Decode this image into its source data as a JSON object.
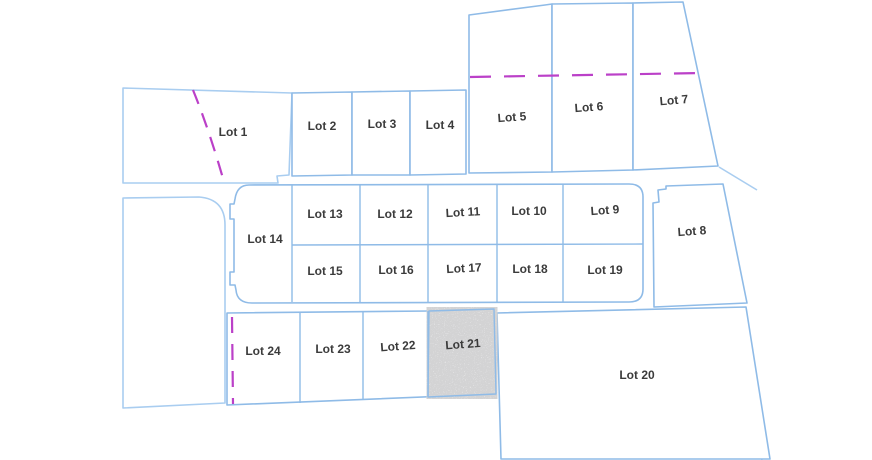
{
  "diagram": {
    "type": "plat-lot-map",
    "colors": {
      "background": "#ffffff",
      "parcel_line": "#8fbbe7",
      "parcel_line_light": "#a9cdf0",
      "easement_line": "#bb40c8",
      "label_text": "#3b3b3b",
      "stipple_fill": "#a6a6a6"
    },
    "lots": [
      {
        "id": "lot-1",
        "label": "Lot 1",
        "outline": "M123,88 L292,93 L289,175 L277,176 L278,183 L123,183 Z",
        "label_x": 233,
        "label_y": 133,
        "label_rotation": 0,
        "tone": "light"
      },
      {
        "id": "lot-2",
        "label": "Lot 2",
        "outline": "M292,93 L352,92 L352,175 L292,176 Z",
        "label_x": 322,
        "label_y": 127,
        "label_rotation": 0,
        "tone": "normal"
      },
      {
        "id": "lot-3",
        "label": "Lot 3",
        "outline": "M352,92 L410,91 L410,175 L352,175 Z",
        "label_x": 382,
        "label_y": 125,
        "label_rotation": 0,
        "tone": "normal"
      },
      {
        "id": "lot-4",
        "label": "Lot 4",
        "outline": "M410,91 L466,90 L466,174 L410,175 Z",
        "label_x": 440,
        "label_y": 126,
        "label_rotation": 0,
        "tone": "normal"
      },
      {
        "id": "lot-5",
        "label": "Lot 5",
        "outline": "M469,15 L545,5 L552,4 L552,172 L469,173 Z",
        "label_x": 512,
        "label_y": 118,
        "label_rotation": -4,
        "tone": "normal"
      },
      {
        "id": "lot-6",
        "label": "Lot 6",
        "outline": "M552,4 L633,3 L633,170 L552,172 Z",
        "label_x": 589,
        "label_y": 108,
        "label_rotation": -4,
        "tone": "normal"
      },
      {
        "id": "lot-7",
        "label": "Lot 7",
        "outline": "M633,3 L683,2 L718,166 L633,170 Z",
        "label_x": 674,
        "label_y": 101,
        "label_rotation": -5,
        "tone": "normal"
      },
      {
        "id": "lot-8",
        "label": "Lot 8",
        "outline": "M666,186 L723,184 L747,303 L654,307 L653,203 L659,202 L658,190 L666,189 Z",
        "label_x": 692,
        "label_y": 232,
        "label_rotation": -4,
        "tone": "normal"
      },
      {
        "id": "lot-9",
        "label": "Lot 9",
        "outline": null,
        "label_x": 605,
        "label_y": 211,
        "label_rotation": -4,
        "tone": "normal"
      },
      {
        "id": "lot-10",
        "label": "Lot 10",
        "outline": null,
        "label_x": 529,
        "label_y": 212,
        "label_rotation": 0,
        "tone": "normal"
      },
      {
        "id": "lot-11",
        "label": "Lot 11",
        "outline": null,
        "label_x": 463,
        "label_y": 213,
        "label_rotation": -3,
        "tone": "normal"
      },
      {
        "id": "lot-12",
        "label": "Lot 12",
        "outline": null,
        "label_x": 395,
        "label_y": 215,
        "label_rotation": 0,
        "tone": "normal"
      },
      {
        "id": "lot-13",
        "label": "Lot 13",
        "outline": null,
        "label_x": 325,
        "label_y": 215,
        "label_rotation": 0,
        "tone": "normal"
      },
      {
        "id": "lot-14",
        "label": "Lot 14",
        "outline": null,
        "label_x": 265,
        "label_y": 240,
        "label_rotation": 0,
        "tone": "normal"
      },
      {
        "id": "lot-15",
        "label": "Lot 15",
        "outline": null,
        "label_x": 325,
        "label_y": 272,
        "label_rotation": 0,
        "tone": "normal"
      },
      {
        "id": "lot-16",
        "label": "Lot 16",
        "outline": null,
        "label_x": 396,
        "label_y": 271,
        "label_rotation": 0,
        "tone": "normal"
      },
      {
        "id": "lot-17",
        "label": "Lot 17",
        "outline": null,
        "label_x": 464,
        "label_y": 269,
        "label_rotation": -3,
        "tone": "normal"
      },
      {
        "id": "lot-18",
        "label": "Lot 18",
        "outline": null,
        "label_x": 530,
        "label_y": 270,
        "label_rotation": 0,
        "tone": "normal"
      },
      {
        "id": "lot-19",
        "label": "Lot 19",
        "outline": null,
        "label_x": 605,
        "label_y": 271,
        "label_rotation": 0,
        "tone": "normal"
      },
      {
        "id": "lot-20",
        "label": "Lot 20",
        "outline": "M497,313 L746,307 L770,459 L501,459 Z",
        "label_x": 637,
        "label_y": 376,
        "label_rotation": 0,
        "tone": "normal"
      },
      {
        "id": "lot-21",
        "label": "Lot 21",
        "outline": null,
        "label_x": 463,
        "label_y": 345,
        "label_rotation": -4,
        "tone": "normal"
      },
      {
        "id": "lot-22",
        "label": "Lot 22",
        "outline": null,
        "label_x": 398,
        "label_y": 347,
        "label_rotation": -4,
        "tone": "normal"
      },
      {
        "id": "lot-23",
        "label": "Lot 23",
        "outline": null,
        "label_x": 333,
        "label_y": 350,
        "label_rotation": 0,
        "tone": "normal"
      },
      {
        "id": "lot-24",
        "label": "Lot 24",
        "outline": null,
        "label_x": 263,
        "label_y": 352,
        "label_rotation": 0,
        "tone": "normal"
      }
    ],
    "blocks": [
      {
        "id": "center-block",
        "outline": "M249,185 L629,184 Q643,184 643,197 L643,289 Q643,302 629,302 L252,303 Q237,303 236,290 L235,285 L230,285 L230,272 L234,272 L234,219 L230,219 L230,204 L234,204 L235,199 Q237,185 249,185 Z",
        "dividers": [
          "M292,185 L292,302",
          "M292,245 L643,244",
          "M360,185 L360,302",
          "M428,184 L428,302",
          "M497,184 L497,302",
          "M563,184 L563,302"
        ]
      },
      {
        "id": "south-row-block",
        "outline": "M227,313 L430,311 L494,309 L496,394 L227,405 Z",
        "dividers": [
          "M300,312 L300,403",
          "M363,312 L363,400",
          "M428,311 L428,397"
        ]
      }
    ],
    "unlabeled_parcels": [
      {
        "id": "west-parcel",
        "path": "M123,198 L199,197 Q225,199 225,225 L225,403 L123,408 Z",
        "closed": true,
        "tone": "light"
      },
      {
        "id": "south-partial-parcel",
        "path": "M630,455 Q700,452 748,452 Q760,452 762,460",
        "closed": false,
        "tone": "light"
      },
      {
        "id": "northeast-boundary-segment",
        "path": "M719,167 L757,190",
        "closed": false,
        "tone": "light"
      }
    ],
    "stippled_area": {
      "id": "lot-21-stipple",
      "for_lot": "Lot 21",
      "shape": "M429,311 L494,309 L496,394 L428,397 Z"
    },
    "easement_lines": [
      {
        "id": "lot-1-curved-easement",
        "path": "M193,90 C204,117 215,150 224,182",
        "dash": "15 10"
      },
      {
        "id": "north-lots-easement",
        "path": "M470,77 L702,73",
        "dash": "21 13"
      },
      {
        "id": "lot-24-west-easement",
        "path": "M232,317 L233,404",
        "dash": "16 11"
      }
    ]
  }
}
